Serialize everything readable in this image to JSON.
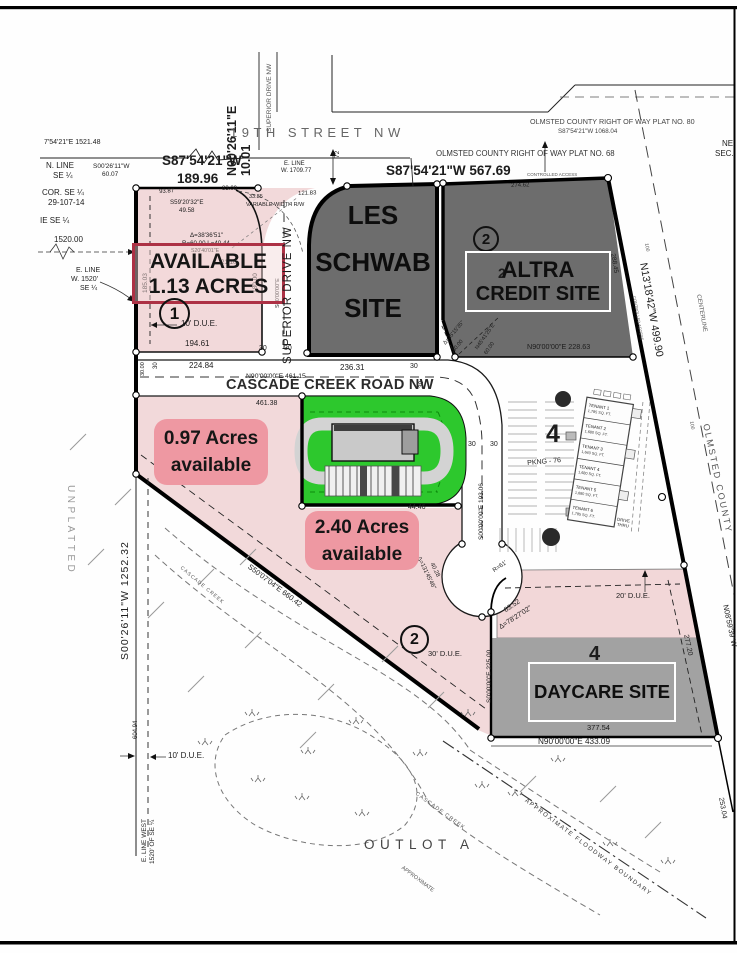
{
  "streets": {
    "nineteenth": "19TH  STREET  NW",
    "superior": "SUPERIOR DRIVE NW",
    "cascade": "CASCADE  CREEK  ROAD  NW"
  },
  "row": {
    "plat80": "OLMSTED  COUNTY  RIGHT  OF  WAY  PLAT  NO.  80",
    "plat80_bearing": "S87'54'21\"W   1068.04",
    "plat68": "OLMSTED  COUNTY  RIGHT  OF  WAY  PLAT  NO.  68",
    "bearing_567": "S87'54'21\"W    567.69",
    "controlled_access": "CONTROLLED ACCESS",
    "centerline": "CENTERLINE",
    "olmsted_county": "OLMSTED  COUNTY",
    "ne": "NE",
    "sec": "SEC."
  },
  "parcels": {
    "available": {
      "number": "1",
      "line1": "AVAILABLE",
      "line2": "1.13 ACRES",
      "due": "10' D.U.E."
    },
    "les_schwab": {
      "line1": "LES",
      "line2": "SCHWAB",
      "line3": "SITE"
    },
    "altra": {
      "number": "2",
      "line1": "ALTRA",
      "line2": "CREDIT  SITE",
      "plat_lot": "2"
    },
    "lot4_parking": {
      "number": "4",
      "stalls": "PKNG - 76",
      "drive_thru_1": "DRIVE",
      "drive_thru_2": "THRU"
    },
    "daycare": {
      "number": "4",
      "label": "DAYCARE SITE",
      "due": "20' D.U.E."
    },
    "acres097": {
      "line1": "0.97 Acres",
      "line2": "available"
    },
    "acres240": {
      "line1": "2.40 Acres",
      "line2": "available",
      "number": "2",
      "due": "30' D.U.E."
    },
    "outlot": "OUTLOT A",
    "unplatted": "UNPLATTED"
  },
  "tenants": [
    {
      "name": "TENANT 1",
      "area": "1,785 SQ. FT."
    },
    {
      "name": "TENANT 2",
      "area": "1,680 SQ. FT."
    },
    {
      "name": "TENANT 3",
      "area": "1,640 SQ. FT."
    },
    {
      "name": "TENANT 4",
      "area": "1,680 SQ. FT."
    },
    {
      "name": "TENANT 5",
      "area": "1,680 SQ. FT."
    },
    {
      "name": "TENANT 6",
      "area": "1,785 SQ. FT."
    }
  ],
  "survey": {
    "b1521": "7'54'21\"E   1521.48",
    "n_line1": "N. LINE",
    "n_line2": "SE ¼",
    "cor1": "COR. SE ¼",
    "cor2": "29-107-14",
    "ie_se": "IE SE ¼",
    "d1520": "1520.00",
    "e_line1": "E. LINE",
    "e_line2": "W. 1520'",
    "e_line3": "SE ¼",
    "s0026_1": "S00'26'11\"W",
    "s0026_2": "60.07",
    "s87a": "S87'54'21\"W",
    "s87b": "189.96",
    "n0026a": "N00'26'11\"E",
    "n0026b": "10.01",
    "e1709_1": "E. LINE",
    "e1709_2": "W. 1709.77",
    "var_rw": "VARIABLE  WIDTH R/W",
    "d33": "33.85",
    "d121": "121.83",
    "d83": "83.09",
    "d93": "93.87",
    "d72": "72",
    "s59a": "S59'20'32\"E",
    "s59b": "49.58",
    "delta38": "Δ=38'36'51\"",
    "r60": "R=60.00  L=40.44",
    "s20": "S20'40'01\"E",
    "d2110": "21.10",
    "d185": "185.03",
    "d180": "180.00",
    "d194": "194.61",
    "s00sd": "S00'00'00\"E",
    "d30": "30",
    "d3000": "30.00",
    "d224": "224.84",
    "d236": "236.31",
    "n90_461": "N90'00'00\"E   461.15",
    "d46138": "461.38",
    "d274": "274.62",
    "d288": "288.45",
    "delta35": "Δ=35'15'35\"",
    "d80": "80.00",
    "n45": "N45'41'25\"E",
    "d60": "60.00",
    "n90_228": "N90'00'00\"E    228.63",
    "n13": "N13'18'42\"W    499.90",
    "d100": "100",
    "s00_193": "S00'00'00\"E   193.06",
    "r61": "R=61'",
    "d4446": "44.46",
    "delta131": "Δ=131'45'46\"",
    "d4028": "40.28",
    "s50": "S50'07'04\"E   660.42",
    "s1252": "S00'26'11\"W    1252.32",
    "due10": "10' D.U.E.",
    "elw1": "E. LINE WEST",
    "elw2": "1520' OF SE ¼",
    "d604": "604.94",
    "cascade_creek": "CASCADE CREEK",
    "floodway": "APPROXIMATE  FLOODWAY  BOUNDARY",
    "approximate": "APPROXIMATE",
    "d253": "253.04",
    "n08": "N08'59'39\"W",
    "d277": "277.20",
    "d8352": "83.52",
    "delta78": "Δ=78'27'02\"",
    "s0_225": "S0'00'00\"E   225.00",
    "d377": "377.54",
    "n90_433": "N90'00'00\"E    433.09"
  },
  "colors": {
    "parcel_pink": "#f2d9da",
    "label_pink": "#ee98a2",
    "available_border": "#ad3145",
    "site_gray": "#6d6d6d",
    "daycare_gray": "#a2a2a2",
    "green": "#2dc82d"
  }
}
